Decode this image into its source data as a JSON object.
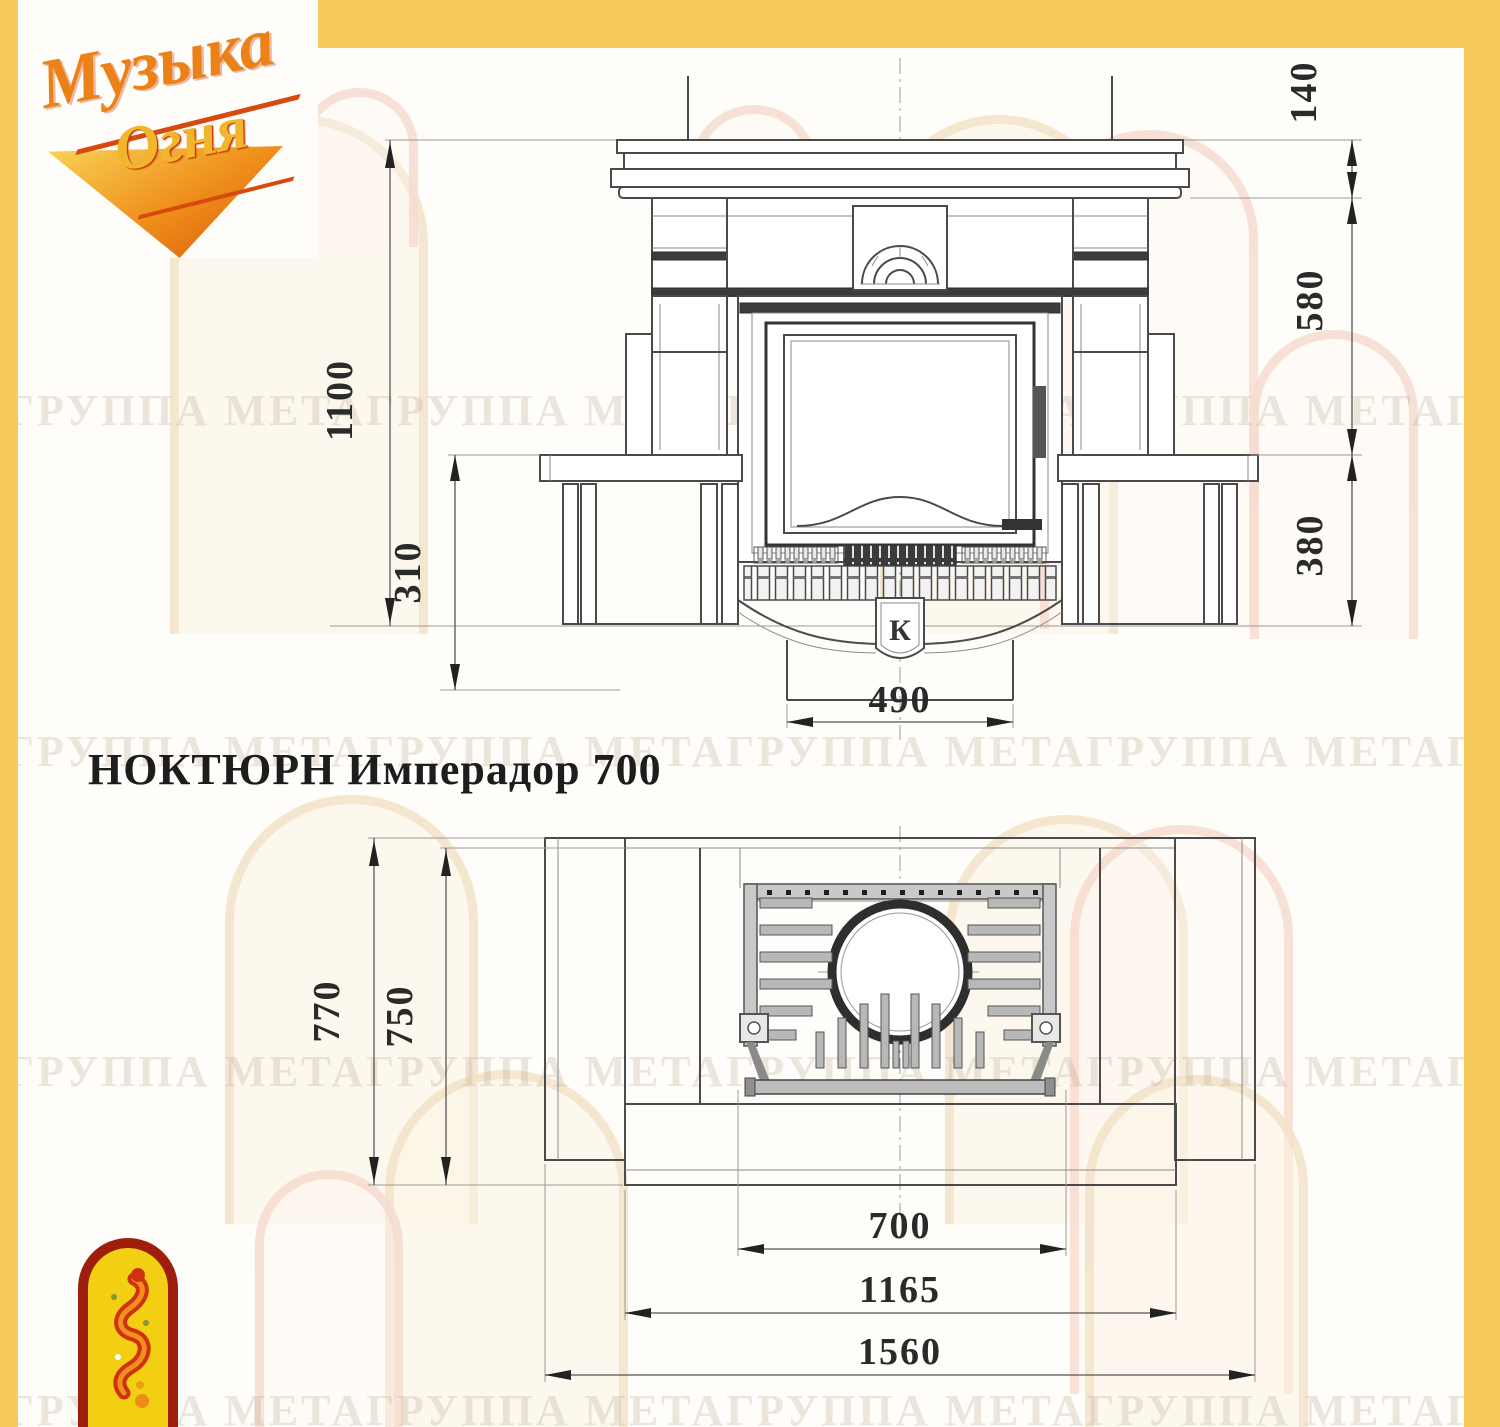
{
  "title": {
    "text": "НОКТЮРН Имперадор 700"
  },
  "logo": {
    "line1": "Музыка",
    "line2": "Огня"
  },
  "watermark": {
    "text": "ГРУППА МЕТАГРУППА МЕТАГРУППА МЕТАГРУППА МЕТАГРУППА МЕТА"
  },
  "front_view": {
    "badge": "К",
    "dims": {
      "total_height": "1100",
      "base_height": "310",
      "shelf_thickness": "140",
      "shelf_to_hearth": "580",
      "hearth_height": "380",
      "plinth_width": "490"
    }
  },
  "plan_view": {
    "dims": {
      "total_depth": "770",
      "body_depth": "750",
      "firebox_width": "700",
      "hearth_width": "1165",
      "total_width": "1560"
    }
  }
}
